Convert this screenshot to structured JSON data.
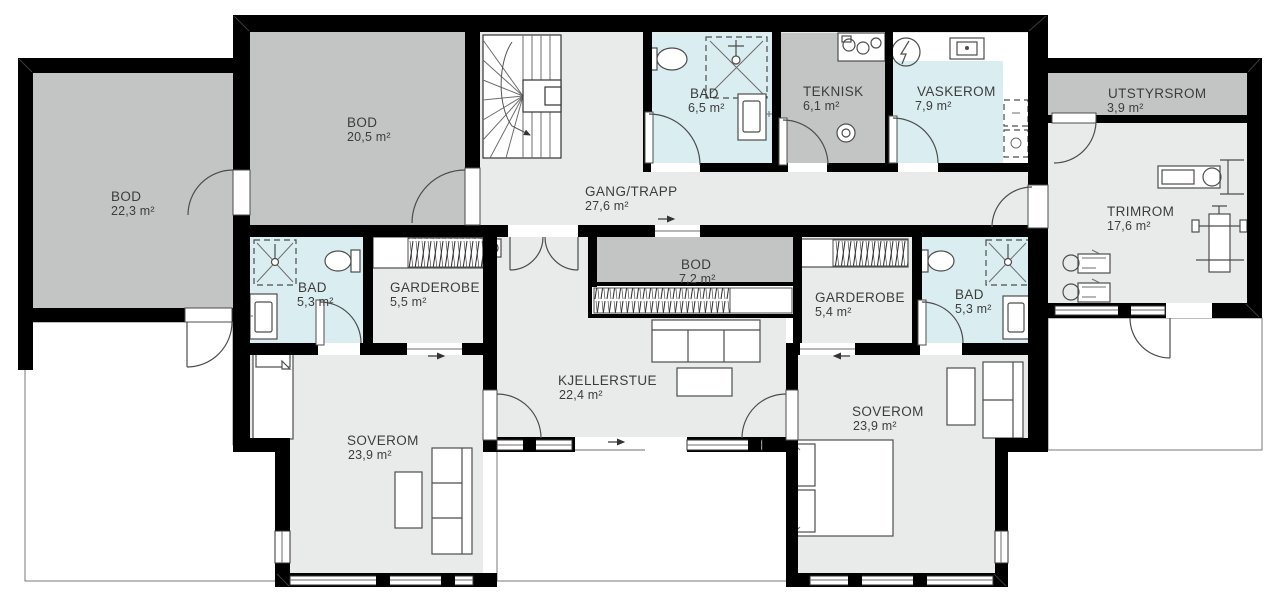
{
  "rooms": {
    "bod_left": {
      "name": "BOD",
      "area": "22,3 m²"
    },
    "bod_top": {
      "name": "BOD",
      "area": "20,5 m²"
    },
    "gang_trapp": {
      "name": "GANG/TRAPP",
      "area": "27,6 m²"
    },
    "bad_top": {
      "name": "BAD",
      "area": "6,5 m²"
    },
    "teknisk": {
      "name": "TEKNISK",
      "area": "6,1 m²"
    },
    "vaskerom": {
      "name": "VASKEROM",
      "area": "7,9 m²"
    },
    "utstyrsrom": {
      "name": "UTSTYRSROM",
      "area": "3,9 m²"
    },
    "trimrom": {
      "name": "TRIMROM",
      "area": "17,6 m²"
    },
    "bad_mid_left": {
      "name": "BAD",
      "area": "5,3 m²"
    },
    "garderobe_left": {
      "name": "GARDEROBE",
      "area": "5,5 m²"
    },
    "bod_mid": {
      "name": "BOD",
      "area": "7,2 m²"
    },
    "garderobe_right": {
      "name": "GARDEROBE",
      "area": "5,4 m²"
    },
    "bad_mid_right": {
      "name": "BAD",
      "area": "5,3 m²"
    },
    "kjellerstue": {
      "name": "KJELLERSTUE",
      "area": "22,4 m²"
    },
    "soverom_left": {
      "name": "SOVEROM",
      "area": "23,9 m²"
    },
    "soverom_right": {
      "name": "SOVEROM",
      "area": "23,9 m²"
    }
  },
  "colors": {
    "wall": "#000000",
    "storage_gray": "#c3c4c4",
    "floor_gray": "#e9eaea",
    "wet_room_blue": "#daedf1",
    "outline": "#4d4d4d",
    "label_text": "#3d3d3d",
    "background": "#ffffff"
  }
}
